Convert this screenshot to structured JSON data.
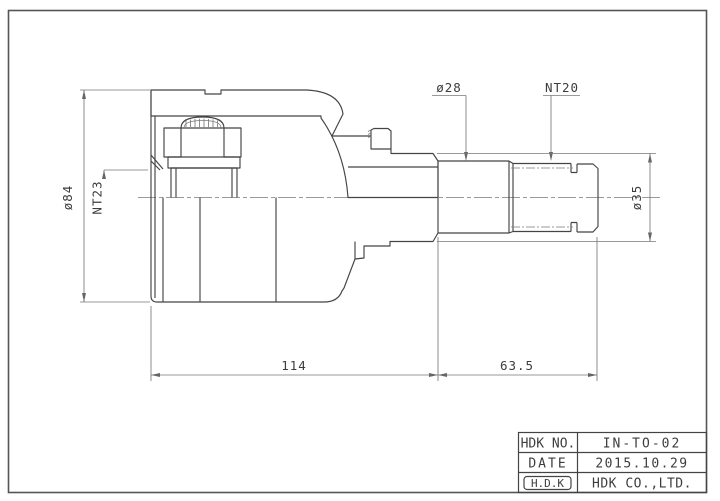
{
  "page": {
    "background": "#ffffff",
    "object_line_color": "#444444",
    "thin_line_color": "#7a7a7a"
  },
  "annotations": {
    "dia_housing": "ø84",
    "spline_housing": "NT23",
    "dia_shaft": "ø28",
    "spline_shaft": "NT20",
    "dia_boot_seat": "ø35",
    "length_housing": "114",
    "length_shaft": "63.5"
  },
  "title_block": {
    "rows": [
      {
        "label": "HDK NO.",
        "value": "IN-TO-02"
      },
      {
        "label": "DATE",
        "value": "2015.10.29"
      },
      {
        "label": "H.D.K",
        "value": "HDK CO.,LTD."
      }
    ]
  }
}
